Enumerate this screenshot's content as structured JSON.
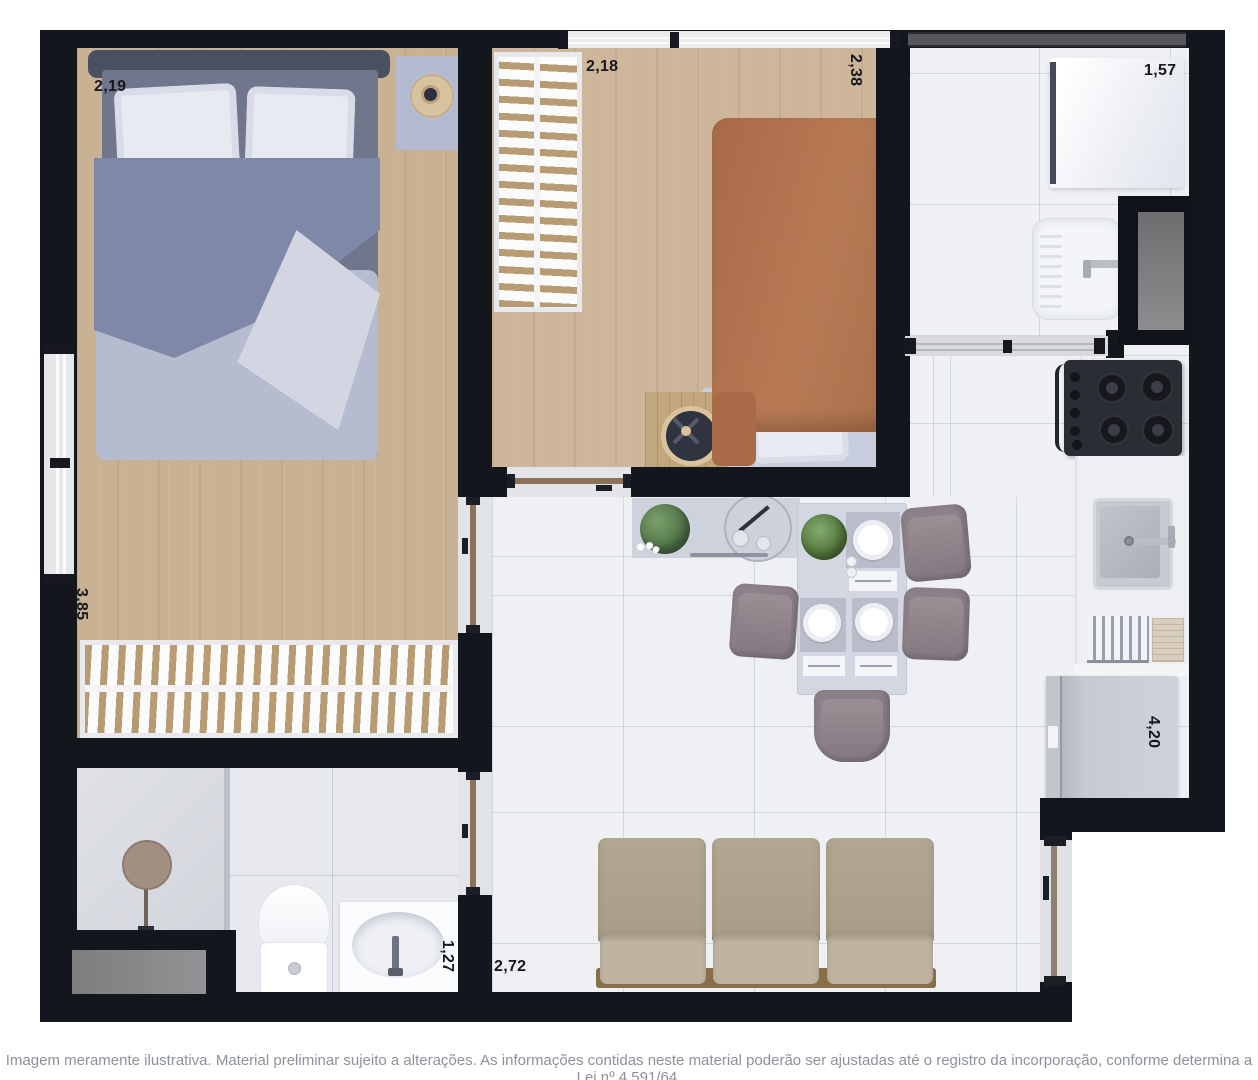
{
  "dimensions": {
    "bedroom1_width": "2,19",
    "bedroom1_length": "3,85",
    "bedroom2_width": "2,18",
    "bedroom2_length": "2,38",
    "laundry_width": "1,57",
    "kitchen_length": "4,20",
    "living_width": "2,72",
    "bathroom_width": "1,27"
  },
  "footer": {
    "disclaimer": "Imagem meramente ilustrativa. Material preliminar sujeito a alterações. As informações contidas neste material poderão ser ajustadas até o registro da incorporação, conforme determina a Lei nº 4.591/64."
  },
  "colors": {
    "wall": "#14161e",
    "wood_floor": "#c9b193",
    "tile_floor": "#eef0f4",
    "duvet_blue": "#7f89a7",
    "duvet_terracotta": "#b17450",
    "sofa_beige": "#b3a892",
    "chair_taupe": "#8d8088"
  }
}
